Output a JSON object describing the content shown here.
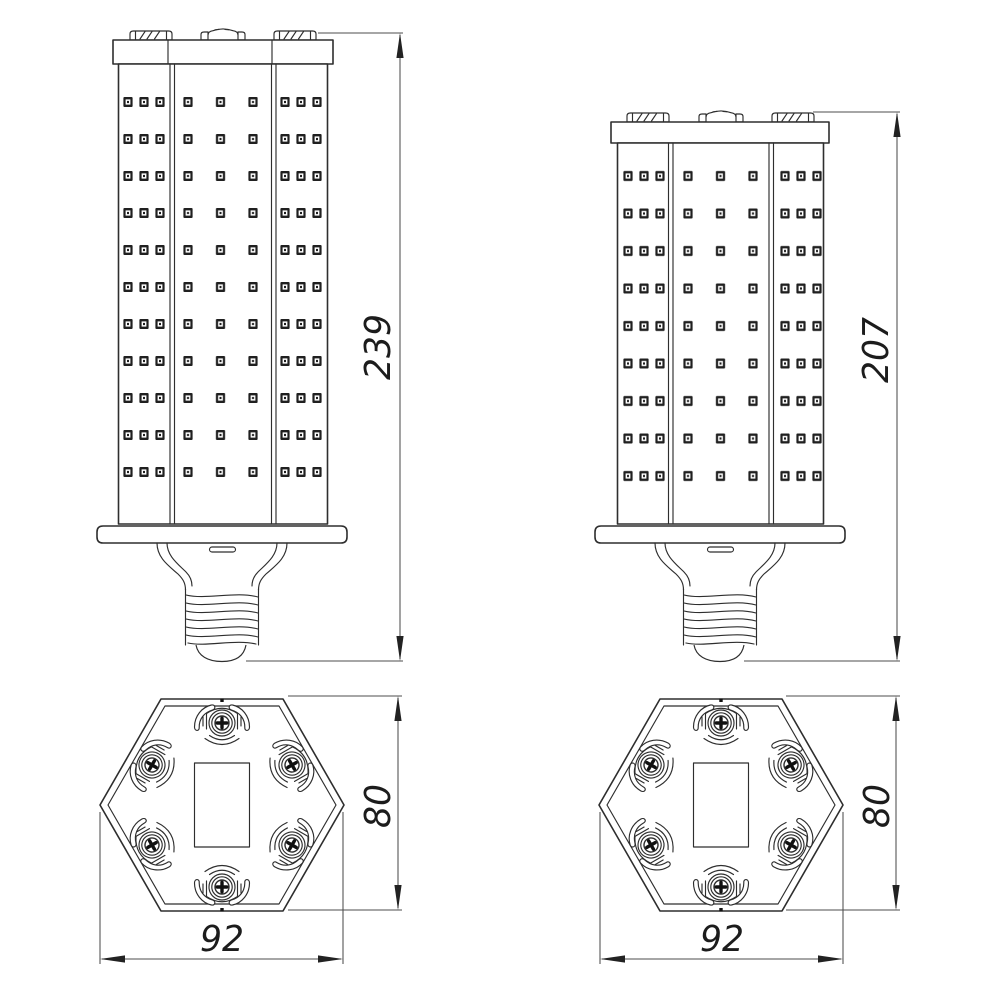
{
  "drawing_type": "led-corn-lamp-technical-drawing",
  "colors": {
    "background": "#ffffff",
    "outline": "#2e2e2e",
    "dimension_lines": "#4d4d4d",
    "text": "#1c1c1c"
  },
  "dimensions": {
    "tall_height": "239",
    "short_height": "207",
    "hex_left_height": "80",
    "hex_left_width": "92",
    "hex_right_height": "80",
    "hex_right_width": "92"
  },
  "counts": {
    "tall_lamp_led_rows": 11,
    "short_lamp_led_rows": 9,
    "led_columns_per_lamp": 9,
    "screws_per_bottom_view": 6,
    "cap_tabs_per_lamp": 3
  }
}
